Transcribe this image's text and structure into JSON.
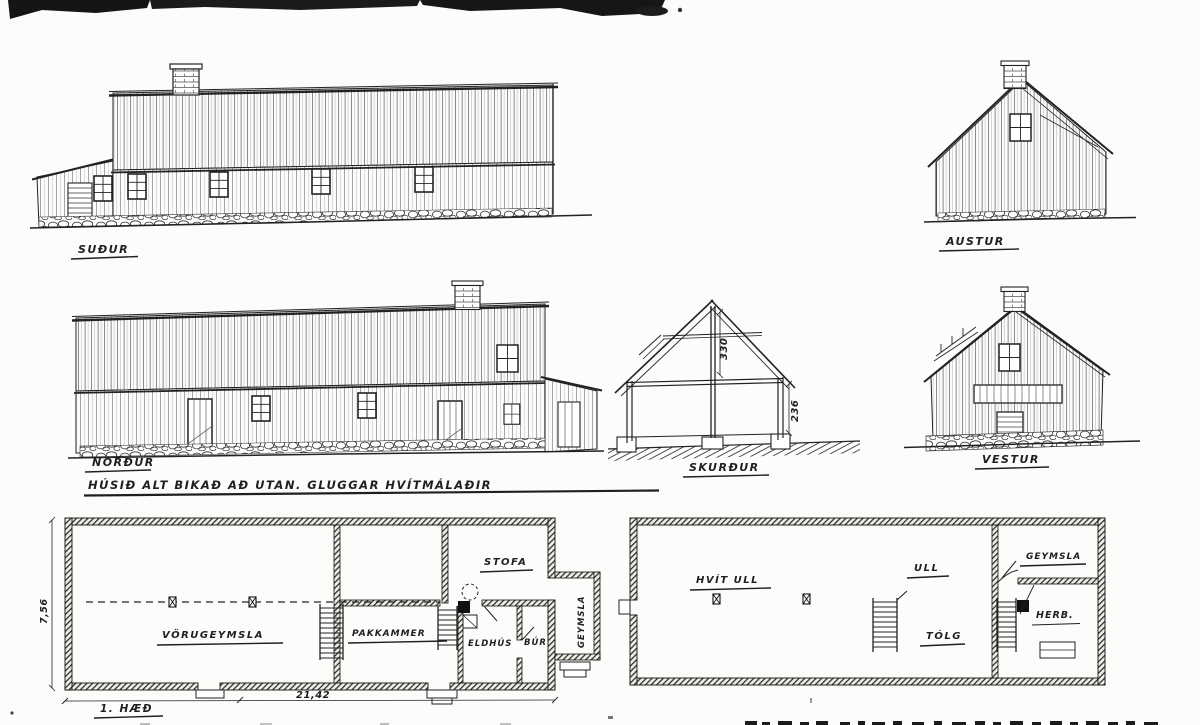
{
  "sheet": {
    "paper_color": "#fcfcfb",
    "ink_color": "#1f1f1f",
    "note": "HÚSIÐ ALT BIKAÐ AÐ UTAN. GLUGGAR HVÍTMÁLAÐIR"
  },
  "elevations": {
    "south": {
      "label": "SUÐUR"
    },
    "east": {
      "label": "AUSTUR"
    },
    "north": {
      "label": "NORÐUR"
    },
    "west": {
      "label": "VESTUR"
    }
  },
  "section": {
    "label": "SKURÐUR",
    "loft_height": "330",
    "wall_height": "236"
  },
  "plan_first_floor": {
    "label": "1. HÆÐ",
    "rooms": {
      "warehouse": "VÖRUGEYMSLA",
      "packing_room": "PAKKAMMER",
      "parlor": "STOFA",
      "kitchen": "ELDHÚS",
      "pantry": "BÚR",
      "storage_annex": "GEYMSLA"
    },
    "dims": {
      "length": "21,42",
      "width": "7,56"
    }
  },
  "plan_loft": {
    "rooms": {
      "white_wool": "HVÍT ULL",
      "wool": "ULL",
      "tallow": "TÓLG",
      "storage": "GEYMSLA",
      "room": "HERB."
    }
  }
}
